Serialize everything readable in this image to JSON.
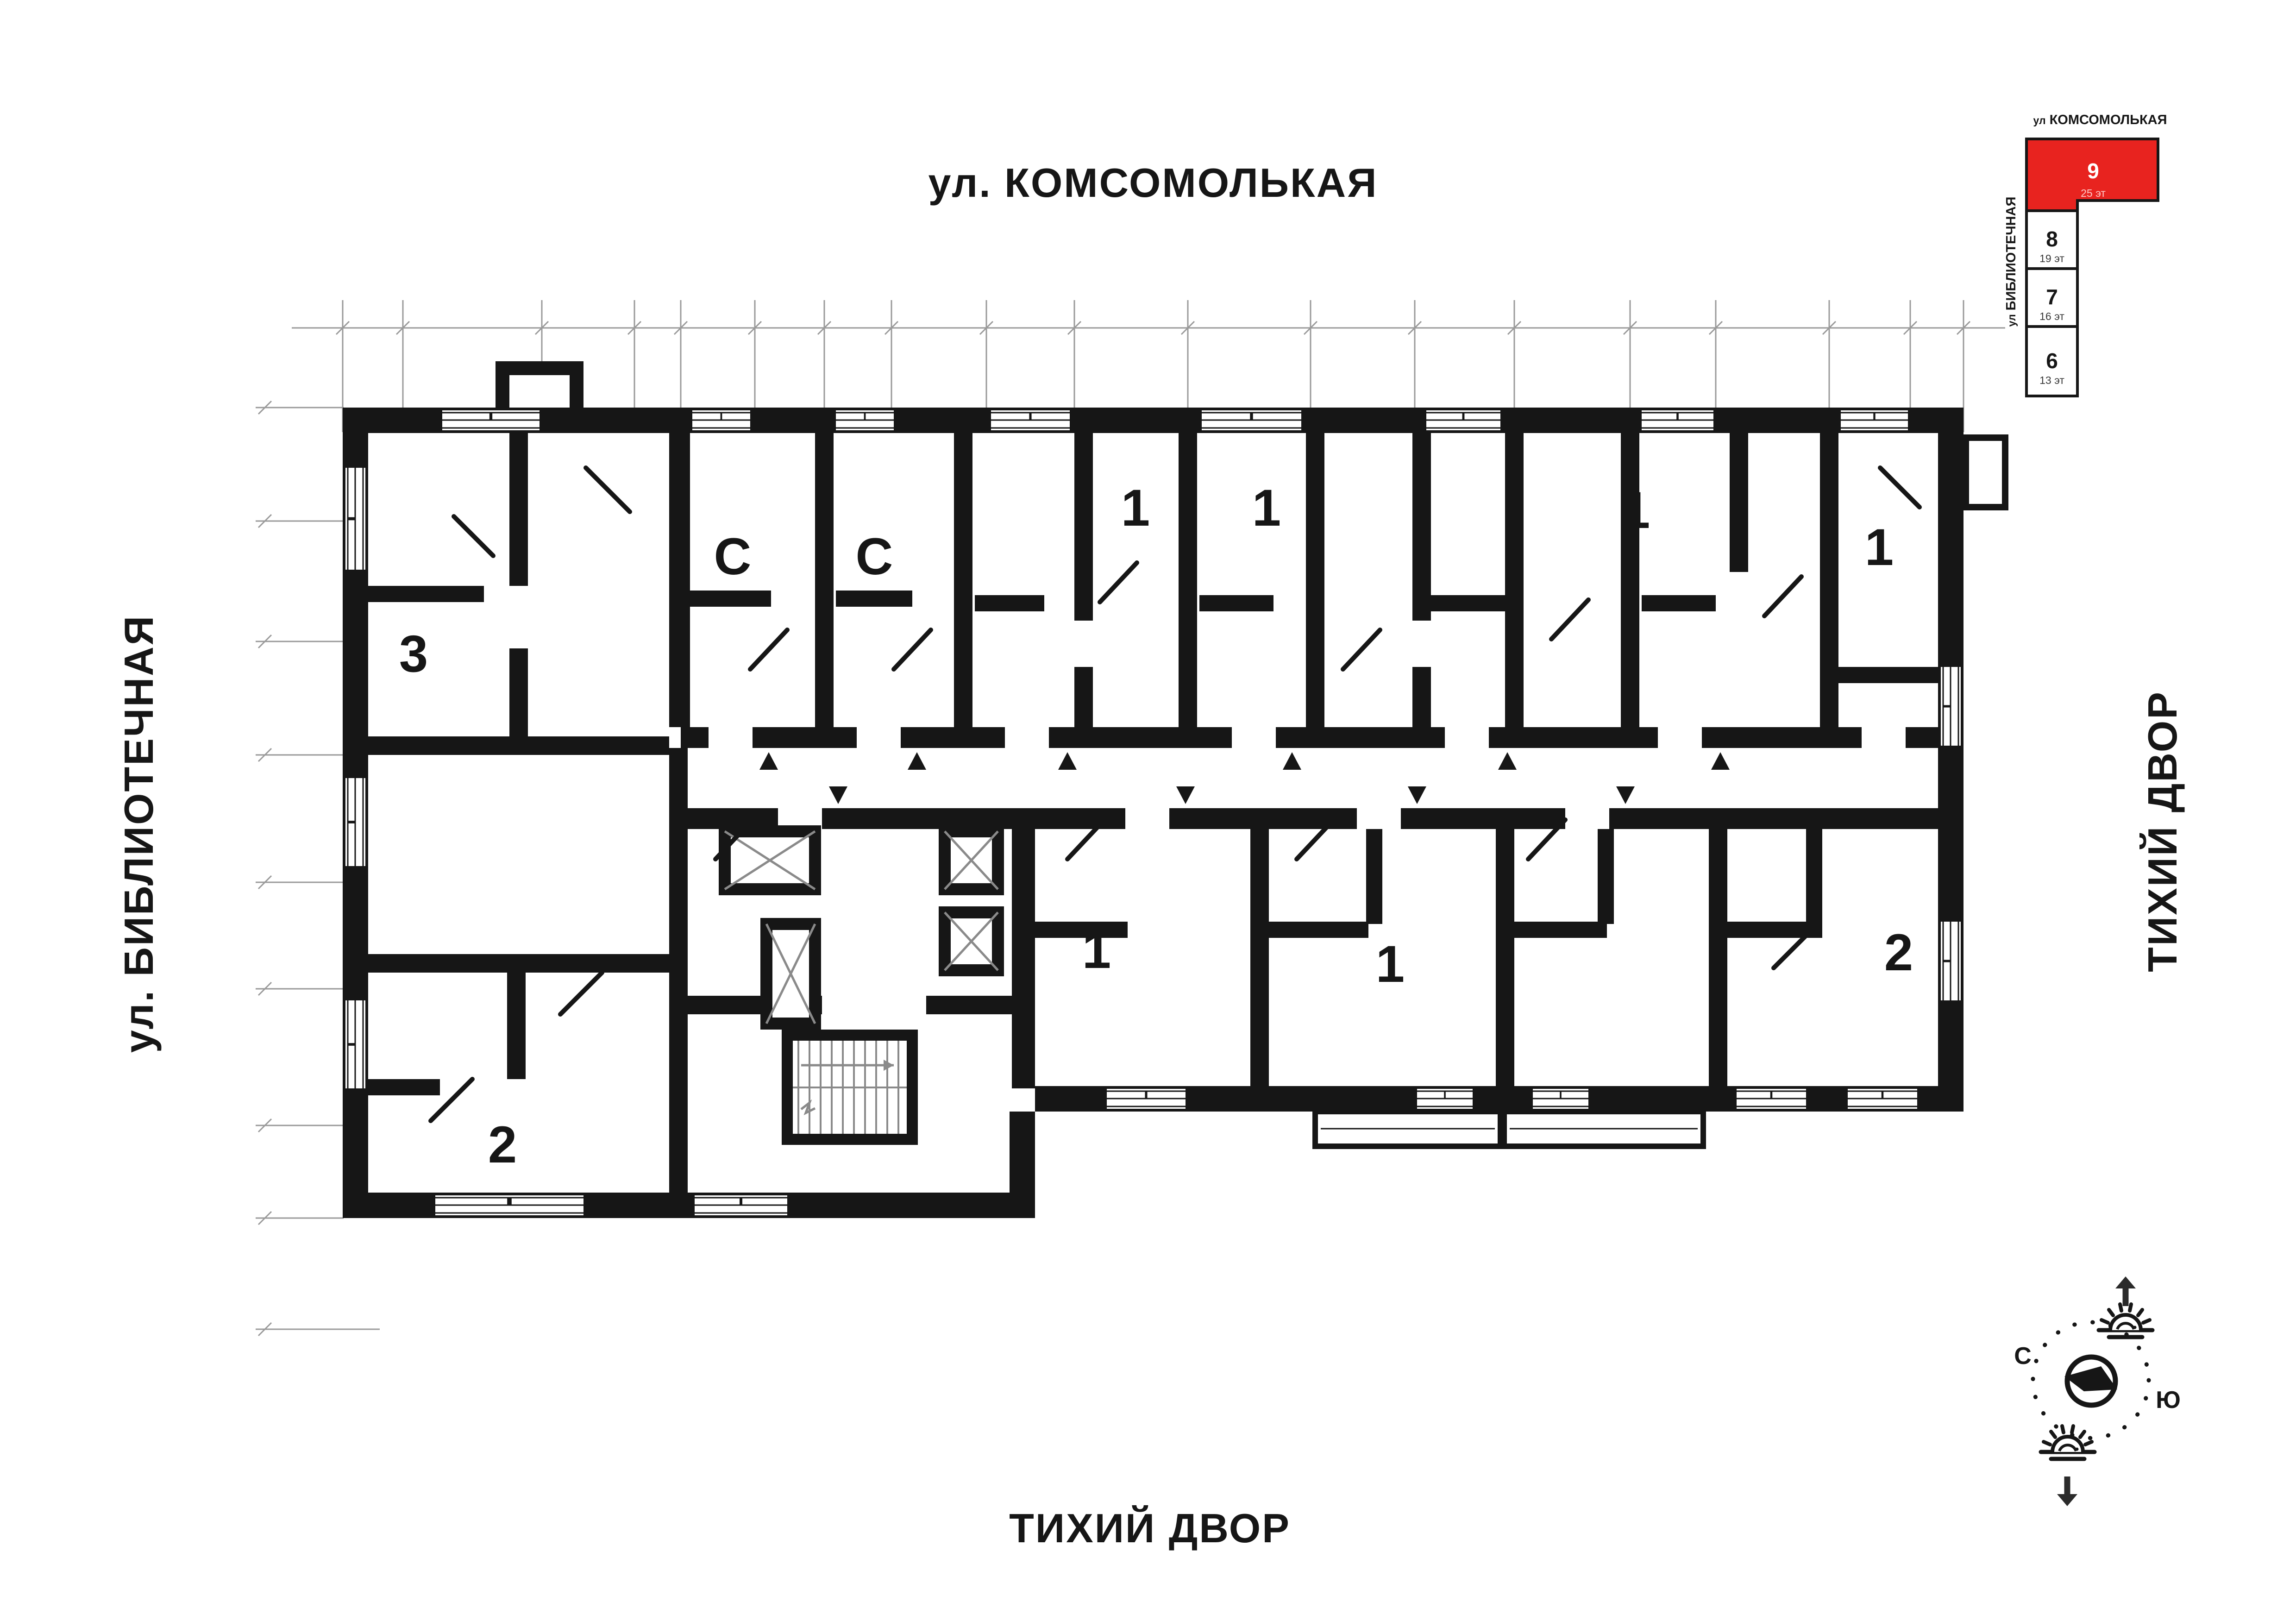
{
  "streets": {
    "top": "ул. КОМСОМОЛЬКАЯ",
    "left": "ул. БИБЛИОТЕЧНАЯ",
    "right": "ТИХИЙ ДВОР",
    "bottom": "ТИХИЙ ДВОР"
  },
  "apartments": [
    {
      "id": "apt-3-left",
      "label": "3"
    },
    {
      "id": "apt-studio-a",
      "label": "С"
    },
    {
      "id": "apt-studio-b",
      "label": "С"
    },
    {
      "id": "apt-1-top-a",
      "label": "1"
    },
    {
      "id": "apt-1-top-b",
      "label": "1"
    },
    {
      "id": "apt-1-top-c",
      "label": "1"
    },
    {
      "id": "apt-1-right",
      "label": "1"
    },
    {
      "id": "apt-1-bottom-a",
      "label": "1"
    },
    {
      "id": "apt-1-bottom-b",
      "label": "1"
    },
    {
      "id": "apt-2-right",
      "label": "2"
    },
    {
      "id": "apt-2-left",
      "label": "2"
    }
  ],
  "minimap": {
    "street_top_prefix": "ул",
    "street_top": "КОМСОМОЛЬКАЯ",
    "street_left_prefix": "ул",
    "street_left": "БИБЛИОТЕЧНАЯ",
    "active_color": "#e8231f",
    "blocks": [
      {
        "num": "9",
        "floors": "25 эт",
        "active": true
      },
      {
        "num": "8",
        "floors": "19 эт",
        "active": false
      },
      {
        "num": "7",
        "floors": "16 эт",
        "active": false
      },
      {
        "num": "6",
        "floors": "13 эт",
        "active": false
      }
    ]
  },
  "compass": {
    "north": "С",
    "south": "Ю"
  }
}
